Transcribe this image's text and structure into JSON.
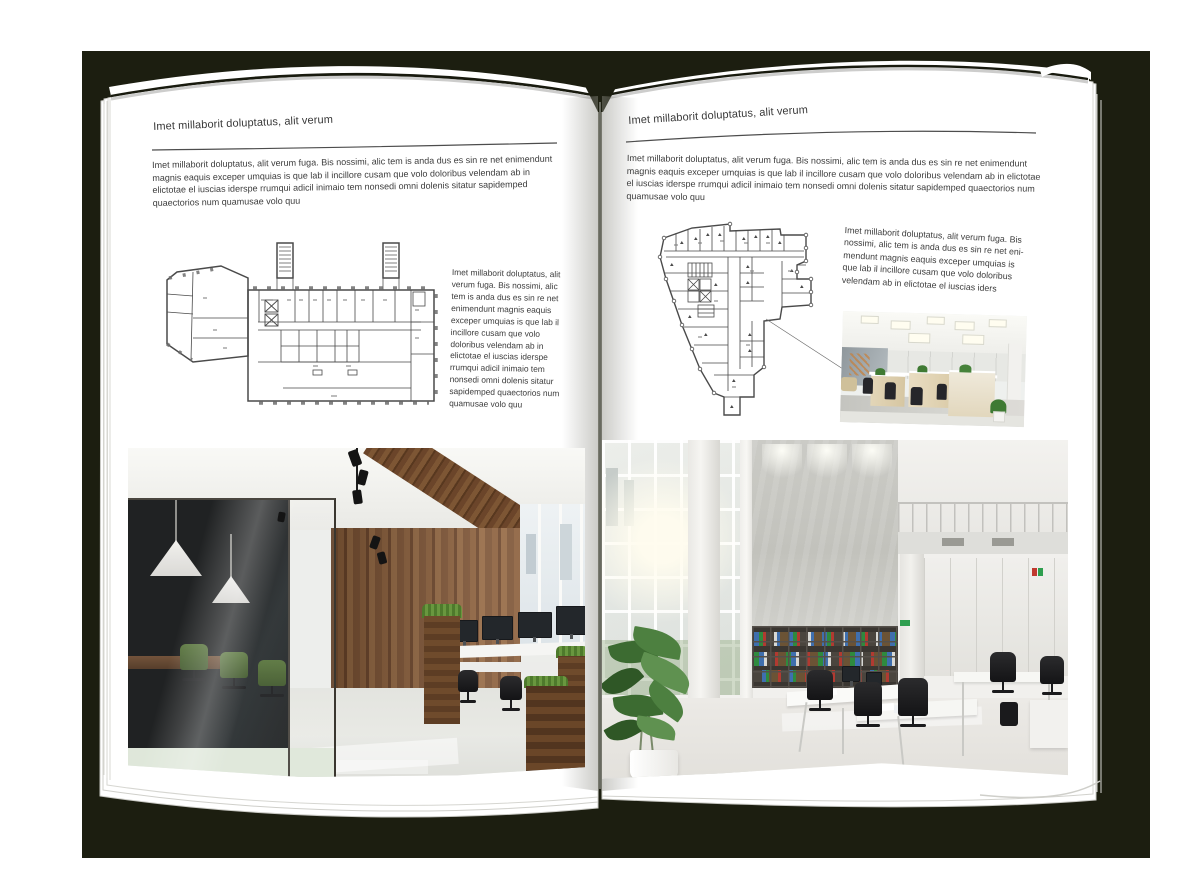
{
  "scene": {
    "backdrop_color": "#1c1e10",
    "page_color": "#ffffff",
    "text_color": "#3b3b3b",
    "rule_color": "#4d4d4d"
  },
  "left_page": {
    "header": "Imet millaborit doluptatus, alit verum",
    "intro": "Imet millaborit doluptatus, alit verum fuga. Bis nossimi, alic tem is anda dus es sin re net enimendunt magnis eaquis exceper umquias is que lab il incillore cusam que volo doloribus velendam ab in elictotae el iuscias iderspe rrumqui adicil inimaio tem nonsedi omni dolenis sitatur sapidemped quaectorios num quamusae volo quu",
    "side_text": "Imet millaborit doluptatus, alit verum fuga. Bis nossimi, alic tem is anda dus es sin re net enimendunt magnis eaquis exceper umquias is que lab il incillore cusam que volo doloribus velendam ab in elictotae el iuscias iderspe rrumqui adicil inimaio tem nonsedi omni dolenis sitatur sapidemped quaectorios num quamusae volo quu"
  },
  "right_page": {
    "header": "Imet millaborit doluptatus, alit verum",
    "intro": "Imet millaborit doluptatus, alit verum fuga. Bis nossimi, alic tem is anda dus es sin re net enimendunt magnis eaquis exceper umquias is que lab il incillore cusam que volo doloribus velendam ab in elictotae el iuscias iderspe rrumqui adicil inimaio tem nonsedi omni dolenis sitatur sapidemped quaectorios num quamusae volo quu",
    "side_text": "Imet millaborit doluptatus, alit verum fuga. Bis nossimi, alic tem is anda dus es sin re net eni-mendunt magnis eaquis exceper umquias is que lab il incillore cusam que volo doloribus velendam ab in elictotae el iuscias iders"
  },
  "figures": {
    "left_floorplan": "wide-building-floor-plan-with-stair-towers",
    "right_floorplan": "irregular-wedge-building-floor-plan",
    "left_photo": "dark-glass-and-wood-office-interior",
    "right_photo_small": "bright-open-plan-office-workstations",
    "right_photo_large": "white-double-height-office-interior"
  }
}
